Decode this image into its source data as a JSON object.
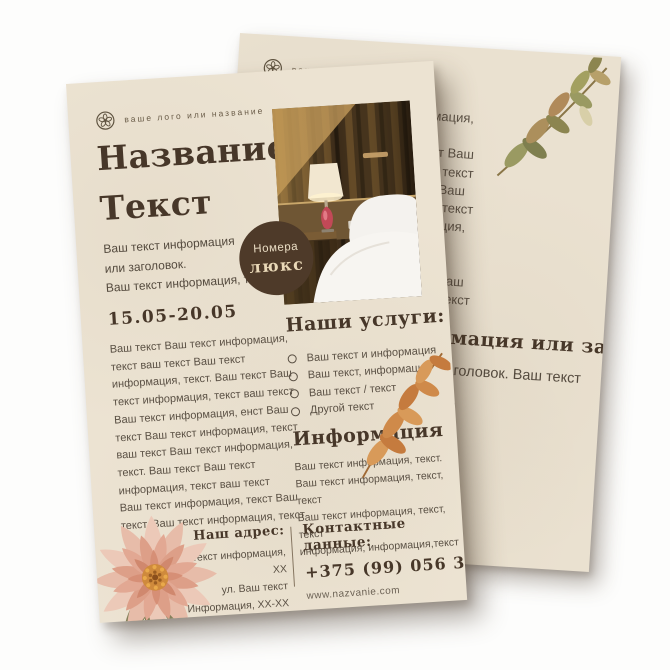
{
  "colors": {
    "page_background": "#fdfdfc",
    "paper_front": "#ece3d2",
    "paper_back": "#eae1d0",
    "heading_ink": "#473729",
    "body_ink": "#5a5044",
    "badge_background": "#4e3a29",
    "badge_text": "#ead9b8"
  },
  "icons": {
    "logo": "floral-emblem-icon",
    "list_bullet": "circle-outline",
    "decorations": [
      "dahlia-flower",
      "orange-leaf-branch",
      "olive-leaf-branch"
    ],
    "photo_subject": "hotel-room-with-bed-and-lamp"
  },
  "front": {
    "logo_label": "ваше лого или название",
    "title": "Название\nТекст",
    "subtitle": "Ваш текст информация\nили заголовок.\nВаш текст информация, текст",
    "date_range": "15.05-20.05",
    "body": "Ваш текст Ваш текст информация,\nтекст ваш текст  Ваш текст\nинформация, текст. Ваш текст  Ваш\nтекст информация, текст ваш текст\nВаш текст информация, енст Ваш\nтекст Ваш текст информация, текст\nваш текст  Ваш текст информация,\nтекст. Ваш текст  Ваш текст\nинформация, текст ваш текст\nВаш текст информация, текст Ваш\nтекст. Ваш текст информация, текст",
    "badge": {
      "top": "Номера",
      "bottom": "люкс"
    },
    "services": {
      "heading": "Наши услуги:",
      "items": [
        "Ваш текст и информация",
        "Ваш текст, информация",
        "Ваш текст / текст",
        "Другой текст"
      ]
    },
    "info": {
      "heading": "Информация",
      "body": "Ваш текст информация, текст.\nВаш текст информация, текст, текст\nВаш текст информация, текст, текст\nинформация, информация,текст"
    },
    "address": {
      "heading": "Наш адрес:",
      "body": "Ваш текст информация, XX\nул. Ваш текст\nИнформация, XX-XX"
    },
    "contacts": {
      "heading": "Контактные данные:",
      "phone": "+375 (99) 056 34 56",
      "website": "www.nazvanie.com"
    }
  },
  "back": {
    "logo_label": "ваше лого или название",
    "body_top": "Ваш текст Ваш текст информация,\nтекст ваш текст  Ваш текст\nинформация, текст. Ваш текст  Ваш\nтекст информация, текст ваш текст\nВаш текст информация, енст Ваш\nтекст Ваш текст информация, текст\nваш текст  Ваш текст информация,\nтекст. Ваш текст  Ваш текст\nинформация, текст ваш текст\nВаш текст информация, текст Ваш\nтекст. Ваш текст информация, текст",
    "heading": "Ваш текст информация или заголовок",
    "subheading": "Ваш текст информация или заголовок. Ваш текст",
    "body_bottom": "Ваш текст  Ваш текст информация,\nтекст ваш текст\nВаш текст информация, текст\nтекст ваш текст  Ваш текст\nинформация, текст Ваш текст\nВаш текст информация, текст\nтекст ваш текст  Ваш текст\nинформация, текст Ваш текст"
  }
}
